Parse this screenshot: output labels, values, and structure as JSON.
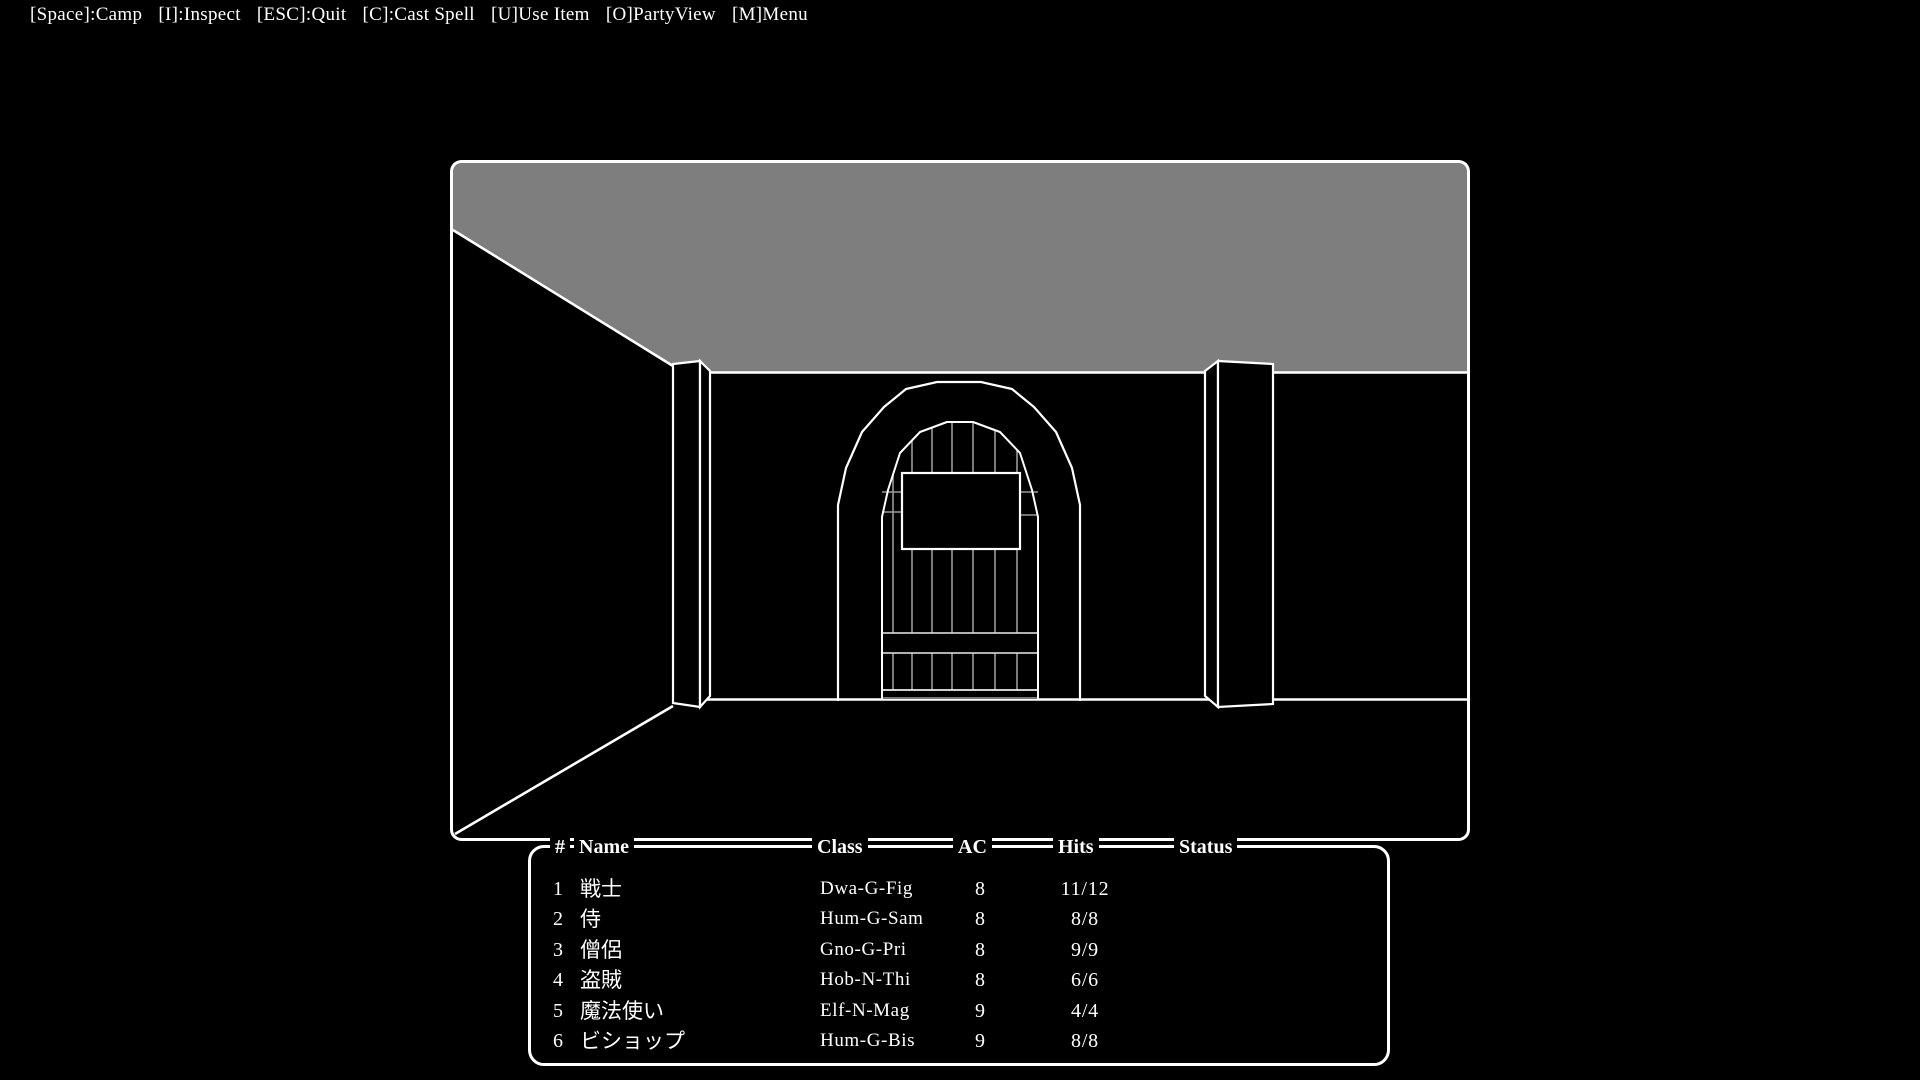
{
  "menu_bar": {
    "items": [
      {
        "label": "[Space]:Camp"
      },
      {
        "label": "[I]:Inspect"
      },
      {
        "label": "[ESC]:Quit"
      },
      {
        "label": "[C]:Cast Spell"
      },
      {
        "label": "[U]Use Item"
      },
      {
        "label": "[O]PartyView"
      },
      {
        "label": "[M]Menu"
      }
    ]
  },
  "viewport": {
    "colors": {
      "background": "#000000",
      "line": "#ffffff",
      "ceiling": "#7e7e7e"
    }
  },
  "party_table": {
    "headers": {
      "num": "#",
      "name": "Name",
      "class": "Class",
      "ac": "AC",
      "hits": "Hits",
      "status": "Status"
    },
    "rows": [
      {
        "num": "1",
        "name": "戦士",
        "class": "Dwa-G-Fig",
        "ac": "8",
        "hits": "11/12",
        "status": ""
      },
      {
        "num": "2",
        "name": "侍",
        "class": "Hum-G-Sam",
        "ac": "8",
        "hits": "8/8",
        "status": ""
      },
      {
        "num": "3",
        "name": "僧侶",
        "class": "Gno-G-Pri",
        "ac": "8",
        "hits": "9/9",
        "status": ""
      },
      {
        "num": "4",
        "name": "盗賊",
        "class": "Hob-N-Thi",
        "ac": "8",
        "hits": "6/6",
        "status": ""
      },
      {
        "num": "5",
        "name": "魔法使い",
        "class": "Elf-N-Mag",
        "ac": "9",
        "hits": "4/4",
        "status": ""
      },
      {
        "num": "6",
        "name": "ビショップ",
        "class": "Hum-G-Bis",
        "ac": "9",
        "hits": "8/8",
        "status": ""
      }
    ]
  }
}
